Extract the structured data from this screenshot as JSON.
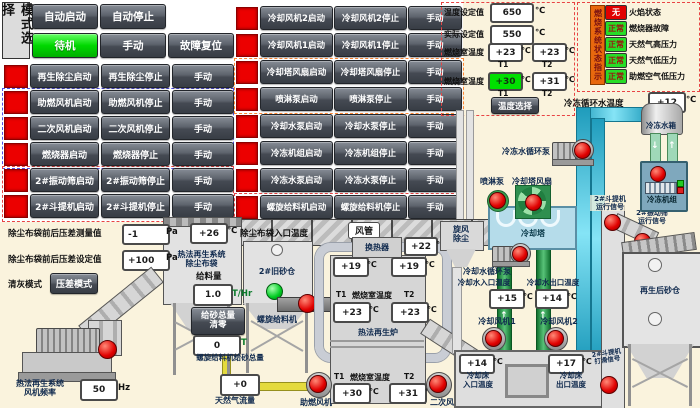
{
  "units": {
    "c": "℃",
    "pa": "Pa",
    "hz": "Hz",
    "t": "T",
    "t_hr": "T/Hr"
  },
  "icons": {
    "up_arrow": "↑",
    "down_arrow": "↓"
  },
  "mode_panel": {
    "title": "模式选择",
    "auto_start": "自动启动",
    "auto_stop": "自动停止",
    "standby": "待机",
    "manual": "手动",
    "fault_reset": "故障复位"
  },
  "left_controls": {
    "rows": [
      {
        "start": "再生除尘启动",
        "stop": "再生除尘停止",
        "manual": "手动"
      },
      {
        "start": "助燃风机启动",
        "stop": "助燃风机停止",
        "manual": "手动"
      },
      {
        "start": "二次风机启动",
        "stop": "二次风机停止",
        "manual": "手动"
      },
      {
        "start": "燃烧器启动",
        "stop": "燃烧器停止",
        "manual": "手动"
      },
      {
        "start": "2#振动筛启动",
        "stop": "2#振动筛停止",
        "manual": "手动"
      },
      {
        "start": "2#斗提机启动",
        "stop": "2#斗提机停止",
        "manual": "手动"
      }
    ]
  },
  "mid_controls": {
    "rows": [
      {
        "start": "冷却风机2启动",
        "stop": "冷却风机2停止",
        "manual": "手动"
      },
      {
        "start": "冷却风机1启动",
        "stop": "冷却风机1停止",
        "manual": "手动"
      },
      {
        "start": "冷却塔风扇启动",
        "stop": "冷却塔风扇停止",
        "manual": "手动"
      },
      {
        "start": "喷淋泵启动",
        "stop": "喷淋泵停止",
        "manual": "手动"
      },
      {
        "start": "冷却水泵启动",
        "stop": "冷却水泵停止",
        "manual": "手动"
      },
      {
        "start": "冷冻机组启动",
        "stop": "冷冻机组停止",
        "manual": "手动"
      },
      {
        "start": "冷冻水泵启动",
        "stop": "冷冻水泵停止",
        "manual": "手动"
      },
      {
        "start": "螺旋给料机启动",
        "stop": "螺旋给料机停止",
        "manual": "手动"
      }
    ]
  },
  "temp_panel": {
    "set_label": "温度设定值",
    "set_value": "650",
    "actual_label": "实际设定值",
    "actual_value": "550",
    "chamber_upper": {
      "label": "燃烧室温度",
      "t1_value": "+23",
      "t2_value": "+23",
      "t1": "T1",
      "t2": "T2"
    },
    "chamber_lower": {
      "label": "燃烧室温度",
      "t1_value": "+30",
      "t2_value": "+31",
      "t1": "T1",
      "t2": "T2"
    },
    "select_button": "温度选择"
  },
  "status_panel": {
    "title": "燃烧系统状态指示",
    "items": [
      {
        "state": "无",
        "label": "火焰状态"
      },
      {
        "state": "正常",
        "label": "燃烧器故障"
      },
      {
        "state": "正常",
        "label": "天然气高压力"
      },
      {
        "state": "正常",
        "label": "天然气低压力"
      },
      {
        "state": "正常",
        "label": "助燃空气低压力"
      }
    ]
  },
  "dust": {
    "dp_measured_label": "除尘布袋前后压差测量值",
    "dp_measured_value": "-1",
    "dp_set_label": "除尘布袋前后压差设定值",
    "dp_set_value": "+100",
    "clean_mode_label": "清灰模式",
    "clean_mode_button": "压差模式",
    "baghouse_line1": "热法再生系统",
    "baghouse_line2": "除尘布袋",
    "fan_freq_line1": "热法再生系统",
    "fan_freq_line2": "风机频率",
    "fan_freq_value": "50",
    "bag_inlet_value": "+26",
    "bag_inlet_label": "除尘布袋入口温度",
    "duct_label": "风管",
    "cyclone_line1": "旋风",
    "cyclone_line2": "除尘"
  },
  "feed": {
    "silo_label": "2#旧砂仓",
    "rate_label": "给料量",
    "rate_value": "1.0",
    "reset_line1": "给砂总量",
    "reset_line2": "清零",
    "total_value": "0",
    "total_label": "螺旋给料机给砂总量",
    "screw_label": "螺旋给料机",
    "gas_value": "+0",
    "gas_label": "天然气流量"
  },
  "furnace": {
    "exchanger_label": "换热器",
    "exchanger_out_value": "+22",
    "top_t1_value": "+19",
    "top_t2_value": "+19",
    "t1": "T1",
    "t2": "T2",
    "chamber_label": "燃烧室温度",
    "mid_t1_value": "+23",
    "mid_t2_value": "+23",
    "name": "热法再生炉",
    "low_t1_value": "+30",
    "low_t2_value": "+31",
    "comb_fan_label": "助燃风机",
    "sec_fan_label": "二次风机"
  },
  "cooling": {
    "spray_pump_label": "喷淋泵",
    "tower_fan_label": "冷却塔风扇",
    "tower_label": "冷却塔",
    "chilled_pump_label": "冷冻水循环泵",
    "cool_pump_label": "冷却水循环泵",
    "water_in_label": "冷却水入口温度",
    "water_in_value": "+15",
    "water_out_label": "冷却水出口温度",
    "water_out_value": "+14",
    "fan1_label": "冷却风机1",
    "fan2_label": "冷却风机2",
    "bed_in_line1": "冷却床",
    "bed_in_line2": "入口温度",
    "bed_in_value": "+14",
    "bed_out_line1": "冷却床",
    "bed_out_line2": "出口温度",
    "bed_out_value": "+17"
  },
  "chiller": {
    "temp_label": "冷冻循环水温度",
    "temp_value": "+12",
    "tank_label": "冷冻水箱",
    "unit_label": "冷冻机组"
  },
  "elevator": {
    "run_line1": "2#斗提机",
    "run_line2": "运行信号",
    "screen_line1": "2#振动筛",
    "screen_line2": "运行信号",
    "slip_line1": "2#斗提机",
    "slip_line2": "打滑信号",
    "silo_label": "再生后砂仓"
  }
}
